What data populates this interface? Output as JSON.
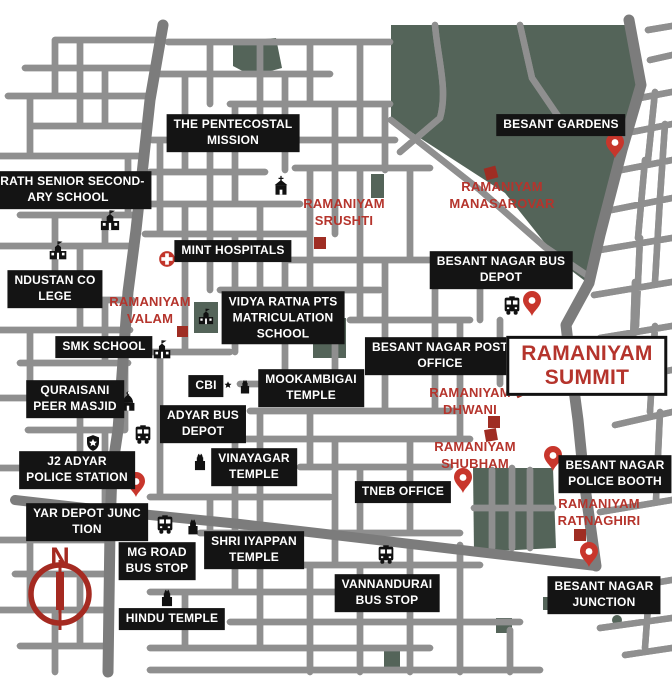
{
  "map": {
    "colors": {
      "label_bg": "#141414",
      "label_text": "#ffffff",
      "accent_red": "#b5342c",
      "marker_red": "#9f2d23",
      "pin_red": "#c8362c",
      "green_area": "#546459",
      "road_major": "#7c7c7c",
      "street_outline": "#8f8f8f",
      "compass_red": "#a52a21"
    },
    "compass": {
      "label": "N"
    },
    "black_labels": [
      {
        "name": "the-pentecostal-mission",
        "lines": [
          "THE PENTECOSTAL",
          "MISSION"
        ],
        "x": 233,
        "y": 133
      },
      {
        "name": "besant-gardens",
        "lines": [
          "BESANT GARDENS"
        ],
        "x": 561,
        "y": 125
      },
      {
        "name": "arath-senior-secondary-school",
        "lines": [
          "ARATH SENIOR SECOND-",
          "ARY SCHOOL"
        ],
        "x": 68,
        "y": 190
      },
      {
        "name": "mint-hospitals",
        "lines": [
          "MINT HOSPITALS"
        ],
        "x": 233,
        "y": 251
      },
      {
        "name": "hindustan-college",
        "lines": [
          "NDUSTAN CO",
          "LEGE"
        ],
        "x": 55,
        "y": 289
      },
      {
        "name": "besant-nagar-bus-depot",
        "lines": [
          "BESANT NAGAR BUS",
          "DEPOT"
        ],
        "x": 501,
        "y": 270
      },
      {
        "name": "smk-school",
        "lines": [
          "SMK SCHOOL"
        ],
        "x": 104,
        "y": 347
      },
      {
        "name": "vidya-ratna-pts-matriculation-school",
        "lines": [
          "VIDYA RATNA PTS",
          "MATRICULATION",
          "SCHOOL"
        ],
        "x": 283,
        "y": 318
      },
      {
        "name": "besant-nagar-post-office",
        "lines": [
          "BESANT NAGAR POST",
          "OFFICE"
        ],
        "x": 440,
        "y": 356
      },
      {
        "name": "quraisani-peer-masjid",
        "lines": [
          "QURAISANI",
          "PEER MASJID"
        ],
        "x": 75,
        "y": 399
      },
      {
        "name": "mookambigai-temple",
        "lines": [
          "MOOKAMBIGAI",
          "TEMPLE"
        ],
        "x": 311,
        "y": 388
      },
      {
        "name": "cbi",
        "lines": [
          "CBI"
        ],
        "x": 206,
        "y": 386
      },
      {
        "name": "adyar-bus-depot",
        "lines": [
          "ADYAR BUS",
          "DEPOT"
        ],
        "x": 203,
        "y": 424
      },
      {
        "name": "j2-adyar-police-station",
        "lines": [
          "J2 ADYAR",
          "POLICE STATION"
        ],
        "x": 77,
        "y": 470
      },
      {
        "name": "vinayagar-temple",
        "lines": [
          "VINAYAGAR",
          "TEMPLE"
        ],
        "x": 254,
        "y": 467
      },
      {
        "name": "tneb-office",
        "lines": [
          "TNEB OFFICE"
        ],
        "x": 403,
        "y": 492
      },
      {
        "name": "besant-nagar-police-booth",
        "lines": [
          "BESANT NAGAR",
          "POLICE BOOTH"
        ],
        "x": 615,
        "y": 474
      },
      {
        "name": "yar-depot-junction",
        "lines": [
          "YAR DEPOT JUNC",
          "TION"
        ],
        "x": 87,
        "y": 522
      },
      {
        "name": "mg-road-bus-stop",
        "lines": [
          "MG ROAD",
          "BUS STOP"
        ],
        "x": 157,
        "y": 561
      },
      {
        "name": "shri-iyappan-temple",
        "lines": [
          "SHRI IYAPPAN",
          "TEMPLE"
        ],
        "x": 254,
        "y": 550
      },
      {
        "name": "vannandurai-bus-stop",
        "lines": [
          "VANNANDURAI",
          "BUS STOP"
        ],
        "x": 387,
        "y": 593
      },
      {
        "name": "besant-nagar-junction",
        "lines": [
          "BESANT NAGAR",
          "JUNCTION"
        ],
        "x": 604,
        "y": 595
      },
      {
        "name": "hindu-temple",
        "lines": [
          "HINDU TEMPLE"
        ],
        "x": 172,
        "y": 619
      }
    ],
    "red_labels": [
      {
        "name": "ramaniyam-srushti",
        "lines": [
          "RAMANIYAM",
          "SRUSHTI"
        ],
        "x": 344,
        "y": 213
      },
      {
        "name": "ramaniyam-manasarovar",
        "lines": [
          "RAMANIYAM",
          "MANASAROVAR"
        ],
        "x": 502,
        "y": 196
      },
      {
        "name": "ramaniyam-valam",
        "lines": [
          "RAMANIYAM",
          "VALAM"
        ],
        "x": 150,
        "y": 311
      },
      {
        "name": "ramaniyam-dhwani",
        "lines": [
          "RAMANIYAM",
          "DHWANI"
        ],
        "x": 470,
        "y": 402
      },
      {
        "name": "ramaniyam-shubham",
        "lines": [
          "RAMANIYAM",
          "SHUBHAM"
        ],
        "x": 475,
        "y": 456
      },
      {
        "name": "ramaniyam-ratnaghiri",
        "lines": [
          "RAMANIYAM",
          "RATNAGHIRI"
        ],
        "x": 599,
        "y": 513
      }
    ],
    "summit_box": {
      "name": "ramaniyam-summit",
      "lines": [
        "RAMANIYAM",
        "SUMMIT"
      ],
      "x": 587,
      "y": 366
    },
    "pins": [
      {
        "name": "pin-besant-gardens",
        "x": 615,
        "y": 158
      },
      {
        "name": "pin-besant-nagar-bus-depot",
        "x": 532,
        "y": 316
      },
      {
        "name": "pin-besant-nagar-post-office",
        "x": 513,
        "y": 361
      },
      {
        "name": "pin-j2-adyar-police-station",
        "x": 136,
        "y": 497
      },
      {
        "name": "pin-ramaniyam-shubham",
        "x": 463,
        "y": 493
      },
      {
        "name": "pin-besant-nagar-police-booth",
        "x": 553,
        "y": 471
      },
      {
        "name": "pin-besant-nagar-junction",
        "x": 589,
        "y": 567
      }
    ],
    "red_squares": [
      {
        "name": "marker-ramaniyam-srushti",
        "x": 320,
        "y": 243,
        "s": 12,
        "r": 0
      },
      {
        "name": "marker-ramaniyam-manasarovar",
        "x": 491,
        "y": 173,
        "s": 12,
        "r": -15
      },
      {
        "name": "marker-ramaniyam-valam",
        "x": 182,
        "y": 331,
        "s": 11,
        "r": 0
      },
      {
        "name": "marker-ramaniyam-dhwani",
        "x": 521,
        "y": 389,
        "s": 14,
        "r": -25
      },
      {
        "name": "marker-ramaniyam-dhwani-2",
        "x": 494,
        "y": 422,
        "s": 12,
        "r": 0
      },
      {
        "name": "marker-ramaniyam-dhwani-3",
        "x": 491,
        "y": 435,
        "s": 12,
        "r": -10
      },
      {
        "name": "marker-ramaniyam-ratnaghiri",
        "x": 580,
        "y": 535,
        "s": 12,
        "r": 0
      }
    ],
    "icons": [
      {
        "type": "hospital",
        "name": "hospital-icon",
        "x": 167,
        "y": 259,
        "s": 20
      },
      {
        "type": "church",
        "name": "church-icon",
        "x": 281,
        "y": 186,
        "s": 22
      },
      {
        "type": "school",
        "name": "school-icon",
        "x": 110,
        "y": 221,
        "s": 23
      },
      {
        "type": "school",
        "name": "school-icon",
        "x": 58,
        "y": 251,
        "s": 21
      },
      {
        "type": "school",
        "name": "school-icon",
        "x": 162,
        "y": 350,
        "s": 21
      },
      {
        "type": "school",
        "name": "school-icon",
        "x": 206,
        "y": 317,
        "s": 18
      },
      {
        "type": "mosque",
        "name": "mosque-icon",
        "x": 128,
        "y": 402,
        "s": 22
      },
      {
        "type": "badge",
        "name": "police-badge-icon",
        "x": 93,
        "y": 443,
        "s": 18
      },
      {
        "type": "badge_white",
        "name": "cbi-badge-icon",
        "x": 228,
        "y": 385,
        "s": 16
      },
      {
        "type": "temple",
        "name": "temple-icon",
        "x": 245,
        "y": 386,
        "s": 18
      },
      {
        "type": "temple",
        "name": "temple-icon",
        "x": 200,
        "y": 461,
        "s": 22
      },
      {
        "type": "temple",
        "name": "temple-icon",
        "x": 193,
        "y": 526,
        "s": 20
      },
      {
        "type": "temple",
        "name": "temple-icon",
        "x": 167,
        "y": 597,
        "s": 22
      },
      {
        "type": "bus",
        "name": "bus-icon",
        "x": 143,
        "y": 434,
        "s": 22
      },
      {
        "type": "bus",
        "name": "bus-icon",
        "x": 512,
        "y": 305,
        "s": 22
      },
      {
        "type": "bus",
        "name": "bus-icon",
        "x": 165,
        "y": 524,
        "s": 22
      },
      {
        "type": "bus",
        "name": "bus-icon",
        "x": 386,
        "y": 554,
        "s": 22
      }
    ]
  }
}
